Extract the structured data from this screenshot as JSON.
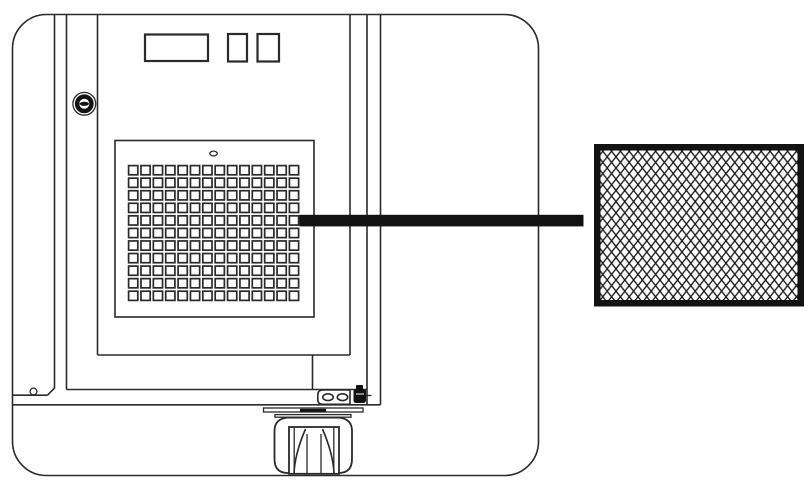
{
  "canvas": {
    "width": 812,
    "height": 486,
    "background": "#ffffff"
  },
  "colors": {
    "ink": "#2a2a2a",
    "black": "#121212",
    "white": "#ffffff"
  },
  "machine": {
    "control_panel": {
      "display_count": 1,
      "button_count": 2
    },
    "lock": {
      "type": "keyed-cam-lock"
    },
    "vent_panel": {
      "screw_slot": "oval"
    },
    "vent_grille": {
      "rows": 11,
      "columns": 14,
      "hole_shape": "square"
    },
    "caster": {
      "type": "swivel-wheel",
      "bracket_holes": 2
    }
  },
  "callout": {
    "target": "vent-grille",
    "points_to": "mesh-filter",
    "color": "#121212"
  },
  "mesh_filter": {
    "pattern": "diamond-mesh",
    "frame_color": "#121212",
    "mesh_color": "#161616"
  }
}
